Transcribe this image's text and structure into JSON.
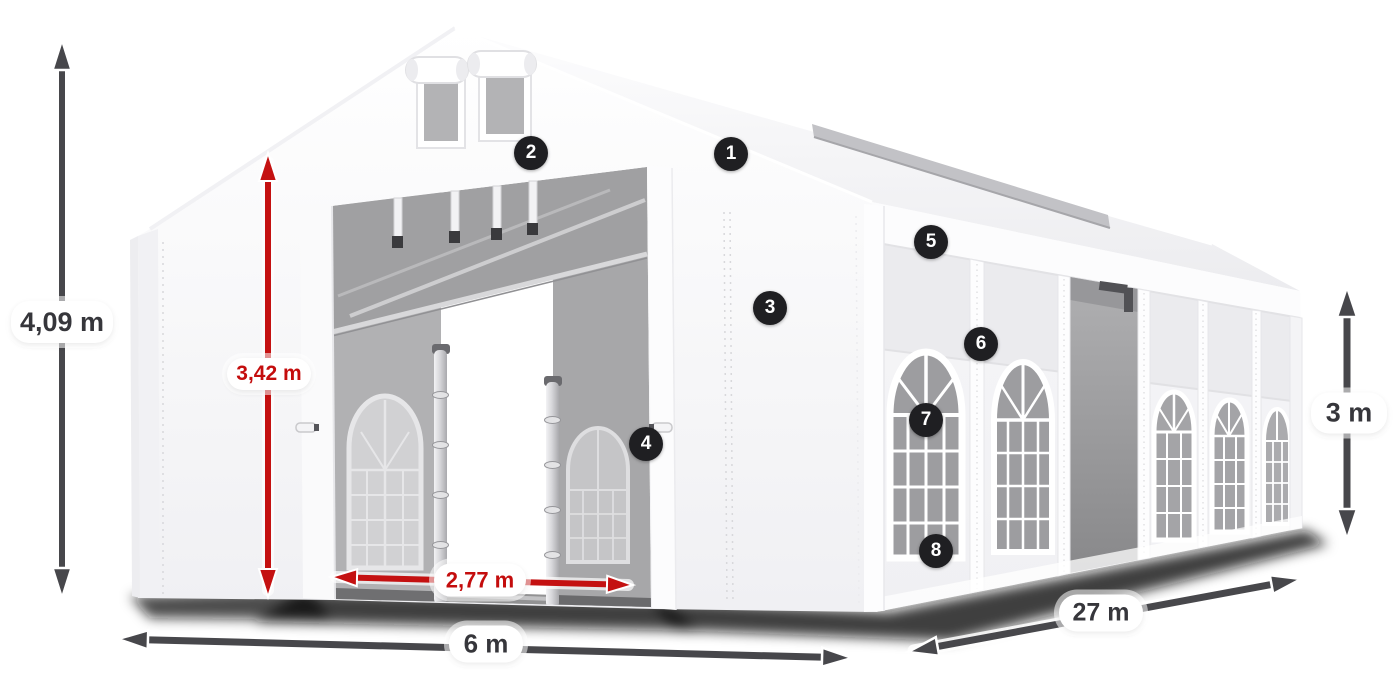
{
  "diagram": {
    "subject": "white marquee tent dimension diagram",
    "dimension_labels": {
      "total_height": "4,09 m",
      "door_height": "3,42 m",
      "door_width": "2,77 m",
      "front_width": "6 m",
      "side_length": "27 m",
      "side_wall_height": "3 m"
    },
    "dimensions": [
      {
        "id": "total-height",
        "label": "4,09 m",
        "orientation": "vertical",
        "color": "dark"
      },
      {
        "id": "door-height",
        "label": "3,42 m",
        "orientation": "vertical",
        "color": "red"
      },
      {
        "id": "door-width",
        "label": "2,77 m",
        "orientation": "horizontal",
        "color": "red"
      },
      {
        "id": "front-width",
        "label": "6 m",
        "orientation": "horizontal",
        "color": "dark"
      },
      {
        "id": "side-length",
        "label": "27 m",
        "orientation": "diagonal",
        "color": "dark"
      },
      {
        "id": "side-wall-height",
        "label": "3 m",
        "orientation": "vertical",
        "color": "dark"
      }
    ],
    "callouts": [
      {
        "number": "1"
      },
      {
        "number": "2"
      },
      {
        "number": "3"
      },
      {
        "number": "4"
      },
      {
        "number": "5"
      },
      {
        "number": "6"
      },
      {
        "number": "7"
      },
      {
        "number": "8"
      }
    ],
    "colors": {
      "dark_arrow": "#47474b",
      "red_arrow": "#c41111",
      "dark_label_text": "#36363b",
      "red_label_text": "#c40d0d",
      "badge_background": "#1f1f22",
      "badge_text": "#ffffff",
      "tent_white": "#f8f8fa",
      "interior_gray": "#a6a6a8",
      "background": "#ffffff"
    }
  }
}
